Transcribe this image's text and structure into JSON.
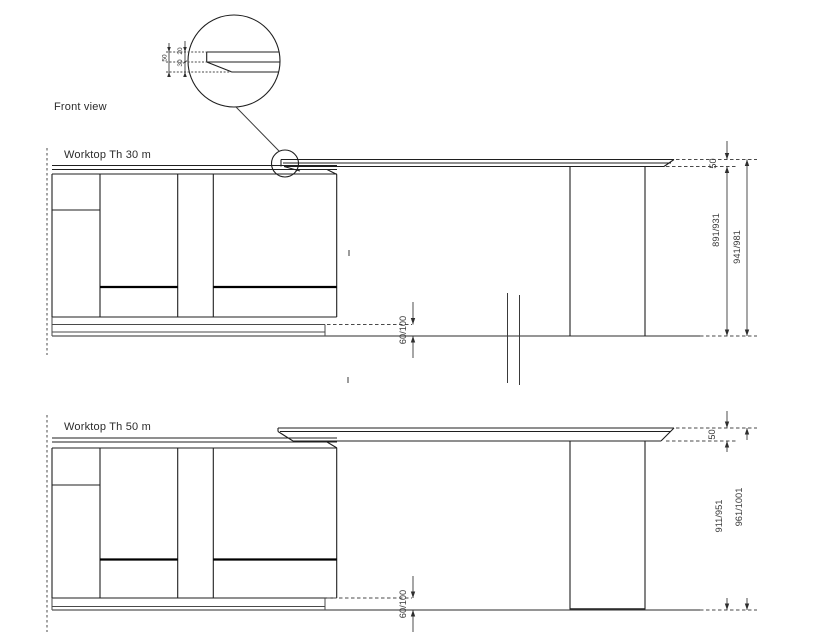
{
  "title": "Front view",
  "detail_callout": {
    "total_thickness": "50",
    "top_face": "20",
    "bevel_depth": "30"
  },
  "drawings": [
    {
      "label": "Worktop Th 30 m",
      "edge_thickness": "50",
      "height_underside": "891/931",
      "height_total": "941/981",
      "plinth_height": "60/100"
    },
    {
      "label": "Worktop Th 50 m",
      "edge_thickness": "50",
      "height_underside": "911/951",
      "height_total": "961/1001",
      "plinth_height": "60/100"
    }
  ]
}
